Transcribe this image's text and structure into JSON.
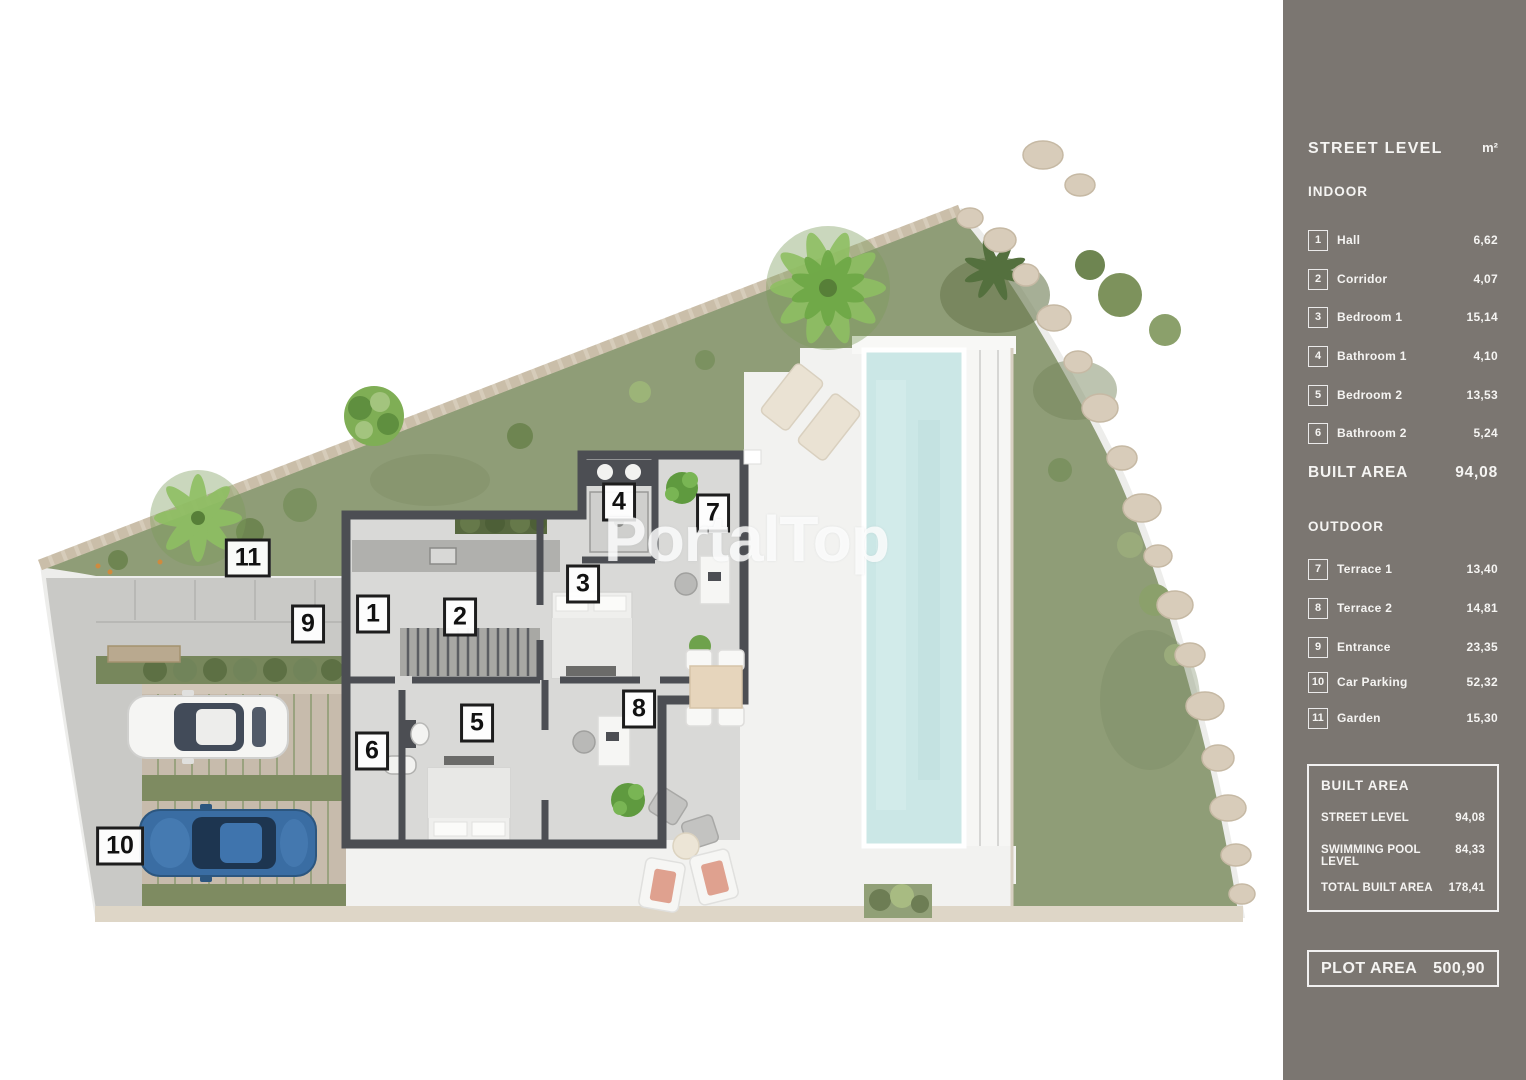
{
  "watermark": "PortalTop",
  "colors": {
    "sidebar_bg": "#7b7671",
    "pool_water": "#cbe7e6",
    "garden_green": "#8f9d77",
    "wall_dark": "#4c4e53"
  },
  "plan": {
    "labels": [
      "1",
      "2",
      "3",
      "4",
      "5",
      "6",
      "7",
      "8",
      "9",
      "10",
      "11"
    ]
  },
  "sidebar": {
    "header": {
      "title": "STREET LEVEL",
      "unit": "m²"
    },
    "indoor": {
      "section": "INDOOR",
      "items": [
        {
          "num": "1",
          "label": "Hall",
          "value": "6,62"
        },
        {
          "num": "2",
          "label": "Corridor",
          "value": "4,07"
        },
        {
          "num": "3",
          "label": "Bedroom 1",
          "value": "15,14"
        },
        {
          "num": "4",
          "label": "Bathroom 1",
          "value": "4,10"
        },
        {
          "num": "5",
          "label": "Bedroom 2",
          "value": "13,53"
        },
        {
          "num": "6",
          "label": "Bathroom 2",
          "value": "5,24"
        }
      ],
      "total_label": "BUILT AREA",
      "total_value": "94,08"
    },
    "outdoor": {
      "section": "OUTDOOR",
      "items": [
        {
          "num": "7",
          "label": "Terrace 1",
          "value": "13,40"
        },
        {
          "num": "8",
          "label": "Terrace 2",
          "value": "14,81"
        },
        {
          "num": "9",
          "label": "Entrance",
          "value": "23,35"
        },
        {
          "num": "10",
          "label": "Car Parking",
          "value": "52,32"
        },
        {
          "num": "11",
          "label": "Garden",
          "value": "15,30"
        }
      ]
    },
    "built_area_box": {
      "title": "BUILT AREA",
      "rows": [
        {
          "label": "STREET LEVEL",
          "value": "94,08"
        },
        {
          "label": "SWIMMING POOL LEVEL",
          "value": "84,33"
        },
        {
          "label": "TOTAL BUILT AREA",
          "value": "178,41"
        }
      ]
    },
    "plot_area_box": {
      "label": "PLOT AREA",
      "value": "500,90"
    }
  }
}
